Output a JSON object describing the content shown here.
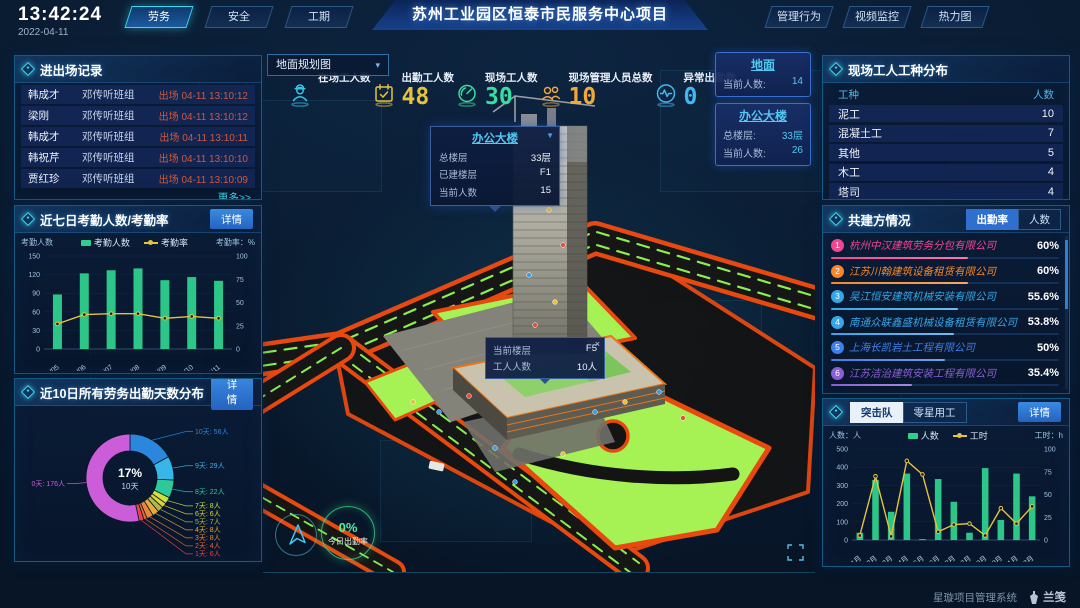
{
  "theme": {
    "accent": "#3ad8f0",
    "lawn": "#a6f255",
    "road_border": "#e8490f",
    "bar_green": "#2fd08e",
    "line_yellow": "#e6c33c"
  },
  "labels": {
    "detail": "详情",
    "more": "更多>>"
  },
  "header": {
    "time": "13:42:24",
    "date": "2022-04-11",
    "title": "苏州工业园区恒泰市民服务中心项目",
    "left_tabs": [
      {
        "label": "劳务",
        "active": true
      },
      {
        "label": "安全",
        "active": false
      },
      {
        "label": "工期",
        "active": false
      }
    ],
    "right_tabs": [
      {
        "label": "管理行为",
        "active": false
      },
      {
        "label": "视频监控",
        "active": false
      },
      {
        "label": "热力图",
        "active": false
      }
    ]
  },
  "panels": {
    "entry_exit": {
      "title": "进出场记录",
      "rows": [
        {
          "name": "韩成才",
          "team": "邓传听班组",
          "event": "出场 04-11 13:10:12"
        },
        {
          "name": "梁刚",
          "team": "邓传听班组",
          "event": "出场 04-11 13:10:12"
        },
        {
          "name": "韩成才",
          "team": "邓传听班组",
          "event": "出场 04-11 13:10:11"
        },
        {
          "name": "韩祝芹",
          "team": "邓传听班组",
          "event": "出场 04-11 13:10:10"
        },
        {
          "name": "贾红珍",
          "team": "邓传听班组",
          "event": "出场 04-11 13:10:09"
        }
      ]
    },
    "worker_types": {
      "title": "现场工人工种分布",
      "headers": [
        "工种",
        "人数"
      ],
      "rows": [
        {
          "type": "泥工",
          "count": "10"
        },
        {
          "type": "混凝土工",
          "count": "7"
        },
        {
          "type": "其他",
          "count": "5"
        },
        {
          "type": "木工",
          "count": "4"
        },
        {
          "type": "塔司",
          "count": "4"
        }
      ]
    },
    "partners": {
      "title": "共建方情况",
      "tabs": [
        {
          "label": "出勤率",
          "active": true
        },
        {
          "label": "人数",
          "active": false
        }
      ],
      "rows": [
        {
          "rank": "1",
          "name": "杭州中汉建筑劳务分包有限公司",
          "value": "60%",
          "pct": 60,
          "color": "#f2478f"
        },
        {
          "rank": "2",
          "name": "江苏川翰建筑设备租赁有限公司",
          "value": "60%",
          "pct": 60,
          "color": "#f5862b"
        },
        {
          "rank": "3",
          "name": "吴江恒安建筑机械安装有限公司",
          "value": "55.6%",
          "pct": 55.6,
          "color": "#35a7e8"
        },
        {
          "rank": "4",
          "name": "南通众联鑫盛机械设备租赁有限公司",
          "value": "53.8%",
          "pct": 53.8,
          "color": "#35a7e8"
        },
        {
          "rank": "5",
          "name": "上海长凯岩土工程有限公司",
          "value": "50%",
          "pct": 50,
          "color": "#3f7fe8"
        },
        {
          "rank": "6",
          "name": "江苏洁治建筑安装工程有限公司",
          "value": "35.4%",
          "pct": 35.4,
          "color": "#8a5fd6"
        }
      ]
    },
    "team": {
      "tabs": [
        {
          "label": "突击队",
          "active": true
        },
        {
          "label": "零星用工",
          "active": false
        }
      ]
    }
  },
  "scene": {
    "map_select": {
      "value": "地面规划图",
      "caret": "▾"
    },
    "stats": [
      {
        "label": "在场工人数",
        "value": "",
        "icon": "worker-icon",
        "color": "#35c7e8"
      },
      {
        "label": "出勤工人数",
        "value": "48",
        "icon": "calendar-check-icon",
        "color": "#e6c33c"
      },
      {
        "label": "现场工人数",
        "value": "30",
        "icon": "gauge-icon",
        "color": "#35e0a0"
      },
      {
        "label": "现场管理人员总数",
        "value": "10",
        "icon": "people-icon",
        "color": "#f0a83a"
      },
      {
        "label": "异常出勤数",
        "value": "0",
        "icon": "pulse-icon",
        "color": "#42b8f0"
      }
    ],
    "building_cards": [
      {
        "title": "地面",
        "rows": [
          {
            "label": "当前人数:",
            "value": "14"
          }
        ]
      },
      {
        "title": "办公大楼",
        "rows": [
          {
            "label": "总楼层:",
            "value": "33层"
          },
          {
            "label": "当前人数:",
            "value": "26"
          }
        ]
      }
    ],
    "building_popup": {
      "title": "办公大楼",
      "caret": "▼",
      "rows": [
        {
          "label": "总楼层",
          "value": "33层"
        },
        {
          "label": "已建楼层",
          "value": "F1"
        },
        {
          "label": "当前人数",
          "value": "15"
        }
      ]
    },
    "floor_tooltip": {
      "close": "×",
      "rows": [
        {
          "label": "当前楼层",
          "value": "F5"
        },
        {
          "label": "工人人数",
          "value": "10人"
        }
      ]
    },
    "attendance_badge": {
      "percent": "0%",
      "label": "今日出勤率"
    }
  },
  "footer": {
    "brand": "星璇项目管理系统",
    "logo": "兰笺"
  },
  "chart_data": [
    {
      "id": "attendance7",
      "type": "bar+line",
      "title": "近七日考勤人数/考勤率",
      "categories": [
        "04/05",
        "04/06",
        "04/07",
        "04/08",
        "04/09",
        "04/10",
        "04/11"
      ],
      "series": [
        {
          "name": "考勤人数",
          "type": "bar",
          "color": "#2fd08e",
          "axis": "left",
          "values": [
            88,
            122,
            127,
            130,
            111,
            116,
            110
          ]
        },
        {
          "name": "考勤率",
          "type": "line",
          "color": "#e6c33c",
          "axis": "right",
          "values": [
            27,
            37,
            38,
            38,
            33,
            35,
            33
          ]
        }
      ],
      "left_axis": {
        "label": "考勤人数",
        "min": 0,
        "max": 150,
        "ticks": [
          0,
          30,
          60,
          90,
          120,
          150
        ]
      },
      "right_axis": {
        "label": "考勤率：%",
        "min": 0,
        "max": 100,
        "ticks": [
          0,
          25,
          50,
          75,
          100
        ]
      },
      "grid": false,
      "legend_position": "top"
    },
    {
      "id": "days10",
      "type": "pie",
      "title": "近10日所有劳务出勤天数分布",
      "center": {
        "percent": "17%",
        "label": "10天"
      },
      "unit": "人",
      "slices": [
        {
          "label": "10天",
          "value": 56,
          "color": "#2b86dd"
        },
        {
          "label": "9天",
          "value": 29,
          "color": "#38b6e8"
        },
        {
          "label": "8天",
          "value": 22,
          "color": "#2ec99b"
        },
        {
          "label": "7天",
          "value": 8,
          "color": "#cfe23c"
        },
        {
          "label": "6天",
          "value": 6,
          "color": "#e0d43a"
        },
        {
          "label": "5天",
          "value": 7,
          "color": "#b0b84a"
        },
        {
          "label": "4天",
          "value": 8,
          "color": "#e8aa3a"
        },
        {
          "label": "3天",
          "value": 8,
          "color": "#e8873a"
        },
        {
          "label": "2天",
          "value": 4,
          "color": "#e8643a"
        },
        {
          "label": "1天",
          "value": 6,
          "color": "#e84444"
        },
        {
          "label": "0天",
          "value": 176,
          "color": "#cb5ed8"
        }
      ]
    },
    {
      "id": "monthly",
      "type": "bar+line",
      "title": "突击队",
      "categories": [
        "1月",
        "2月",
        "3月",
        "4月",
        "5月",
        "6月",
        "7月",
        "8月",
        "9月",
        "10月",
        "11月",
        "12月"
      ],
      "series": [
        {
          "name": "人数",
          "type": "bar",
          "color": "#2fd08e",
          "axis": "left",
          "values": [
            40,
            330,
            155,
            365,
            5,
            335,
            210,
            40,
            395,
            110,
            365,
            240
          ]
        },
        {
          "name": "工时",
          "type": "line",
          "color": "#e6c33c",
          "axis": "right",
          "values": [
            5,
            70,
            4,
            87,
            72,
            9,
            17,
            18,
            5,
            35,
            18,
            37
          ]
        }
      ],
      "left_axis": {
        "label": "人数：人",
        "min": 0,
        "max": 500,
        "ticks": [
          0,
          100,
          200,
          300,
          400,
          500
        ]
      },
      "right_axis": {
        "label": "工时：h",
        "min": 0,
        "max": 100,
        "ticks": [
          0,
          25,
          50,
          75,
          100
        ]
      },
      "grid": false,
      "legend_position": "top"
    }
  ]
}
